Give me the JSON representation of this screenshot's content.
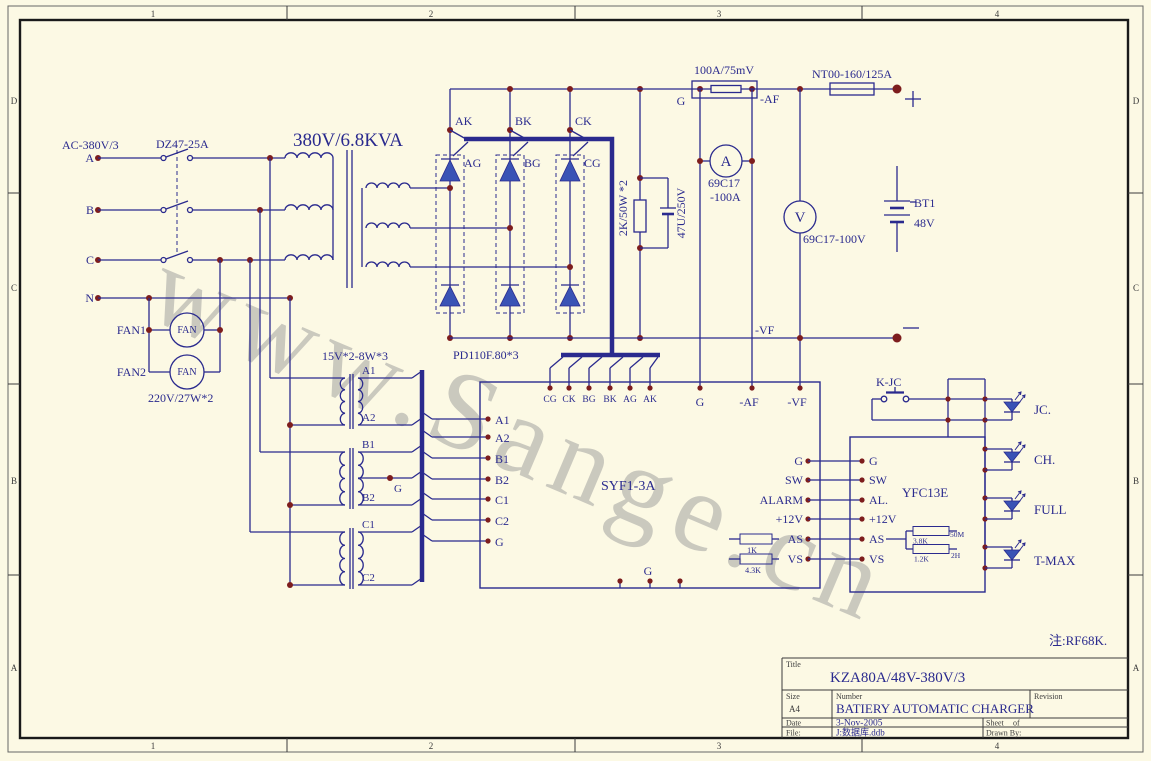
{
  "colors": {
    "bg": "#fcf9e4",
    "wire": "#2a2a8e",
    "junction": "#7d1d1d",
    "device_fill": "#3a53b5"
  },
  "watermark": "www.Sange.cn",
  "note": "注:RF68K.",
  "border": {
    "cols": [
      "1",
      "2",
      "3",
      "4"
    ],
    "rows": [
      "D",
      "C",
      "B",
      "A"
    ]
  },
  "ac": {
    "label": "AC-380V/3",
    "breaker": "DZ47-25A",
    "phase_a": "A",
    "phase_b": "B",
    "phase_c": "C",
    "neutral": "N"
  },
  "fans": {
    "fan1": "FAN1",
    "fan2": "FAN2",
    "motor": "FAN",
    "power": "220V/27W*2"
  },
  "main_transformer": {
    "rating": "380V/6.8KVA"
  },
  "aux_transformer": {
    "rating": "15V*2-8W*3",
    "taps": [
      "A1",
      "A2",
      "B1",
      "G",
      "B2",
      "C1",
      "C2"
    ]
  },
  "rectifier": {
    "module": "PD110F.80*3",
    "cathode_leads": [
      "AK",
      "BK",
      "CK"
    ],
    "gate_leads": [
      "AG",
      "BG",
      "CG"
    ],
    "bleeder_resistor": "2K/50W *2",
    "filter_cap": "47U/250V"
  },
  "dc_bus": {
    "shunt": "100A/75mV",
    "g": "G",
    "neg_af": "-AF",
    "fuse": "NT00-160/125A",
    "neg_vf": "-VF",
    "ammeter_type": "69C17",
    "ammeter_range": "-100A",
    "ammeter_symbol": "A",
    "voltmeter_type": "69C17-100V",
    "voltmeter_symbol": "V",
    "battery_name": "BT1",
    "battery_voltage": "48V"
  },
  "controller": {
    "name": "SYF1-3A",
    "harness_pins": [
      "CG",
      "CK",
      "BG",
      "BK",
      "AG",
      "AK"
    ],
    "top_pins": [
      "G",
      "-AF",
      "-VF"
    ],
    "left_pins": [
      "A1",
      "A2",
      "B1",
      "B2",
      "C1",
      "C2",
      "G"
    ],
    "right_pins": [
      "G",
      "SW",
      "ALARM",
      "+12V",
      "AS",
      "VS"
    ],
    "bottom_pin": "G",
    "as_resistor": "1K",
    "vs_resistor": "4.3K"
  },
  "display_board": {
    "name": "YFC13E",
    "left_pins": [
      "G",
      "SW",
      "AL.",
      "+12V",
      "AS",
      "VS"
    ],
    "relay": "K-JC",
    "leds": [
      "JC.",
      "CH.",
      "FULL",
      "T-MAX"
    ],
    "r_top": "3.8K",
    "r_top_right": "50M",
    "r_bottom": "1.2K",
    "r_bottom_right": "2H"
  },
  "titleblock": {
    "title_label": "Title",
    "title": "KZA80A/48V-380V/3",
    "size_label": "Size",
    "size": "A4",
    "number_label": "Number",
    "number": "BATIERY AUTOMATIC CHARGER",
    "revision_label": "Revision",
    "date_label": "Date",
    "date": "3-Nov-2005",
    "sheet_label": "Sheet",
    "of_label": "of",
    "file_label": "File:",
    "file": "J:数据库.ddb",
    "drawn_label": "Drawn By:"
  }
}
